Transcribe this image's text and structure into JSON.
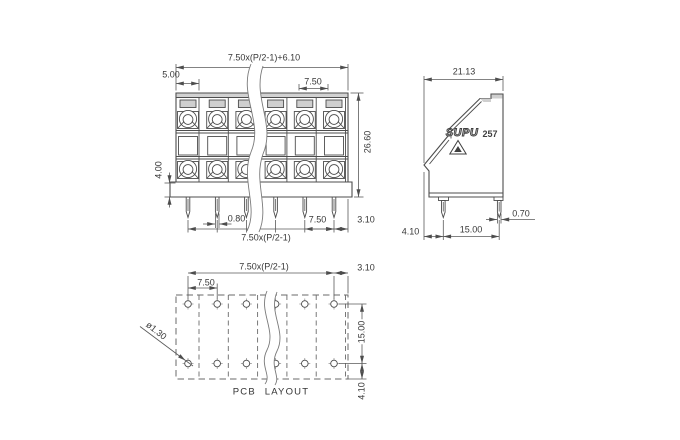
{
  "drawing": {
    "front_view": {
      "dims": {
        "overall_width": "7.50x(P/2-1)+6.10",
        "lead_width": "5.00",
        "pole_pitch_top": "7.50",
        "overall_height": "26.60",
        "base_height": "4.00",
        "pin_width": "0.80",
        "pin_pitch": "7.50",
        "pin_edge_offset": "3.10",
        "pin_span": "7.50x(P/2-1)"
      }
    },
    "side_view": {
      "dims": {
        "overall_depth": "21.13",
        "pin_width": "0.70",
        "pin_row_spacing": "15.00",
        "pin_front_offset": "4.10"
      },
      "marking": {
        "brand": "SUPU",
        "model": "257"
      }
    },
    "pcb_layout": {
      "caption": "PCB LAYOUT",
      "dims": {
        "hole_span": "7.50x(P/2-1)",
        "edge_offset": "3.10",
        "hole_pitch": "7.50",
        "hole_diameter": "ø1.30",
        "row_spacing": "15.00",
        "row_bottom_offset": "4.10"
      }
    }
  }
}
